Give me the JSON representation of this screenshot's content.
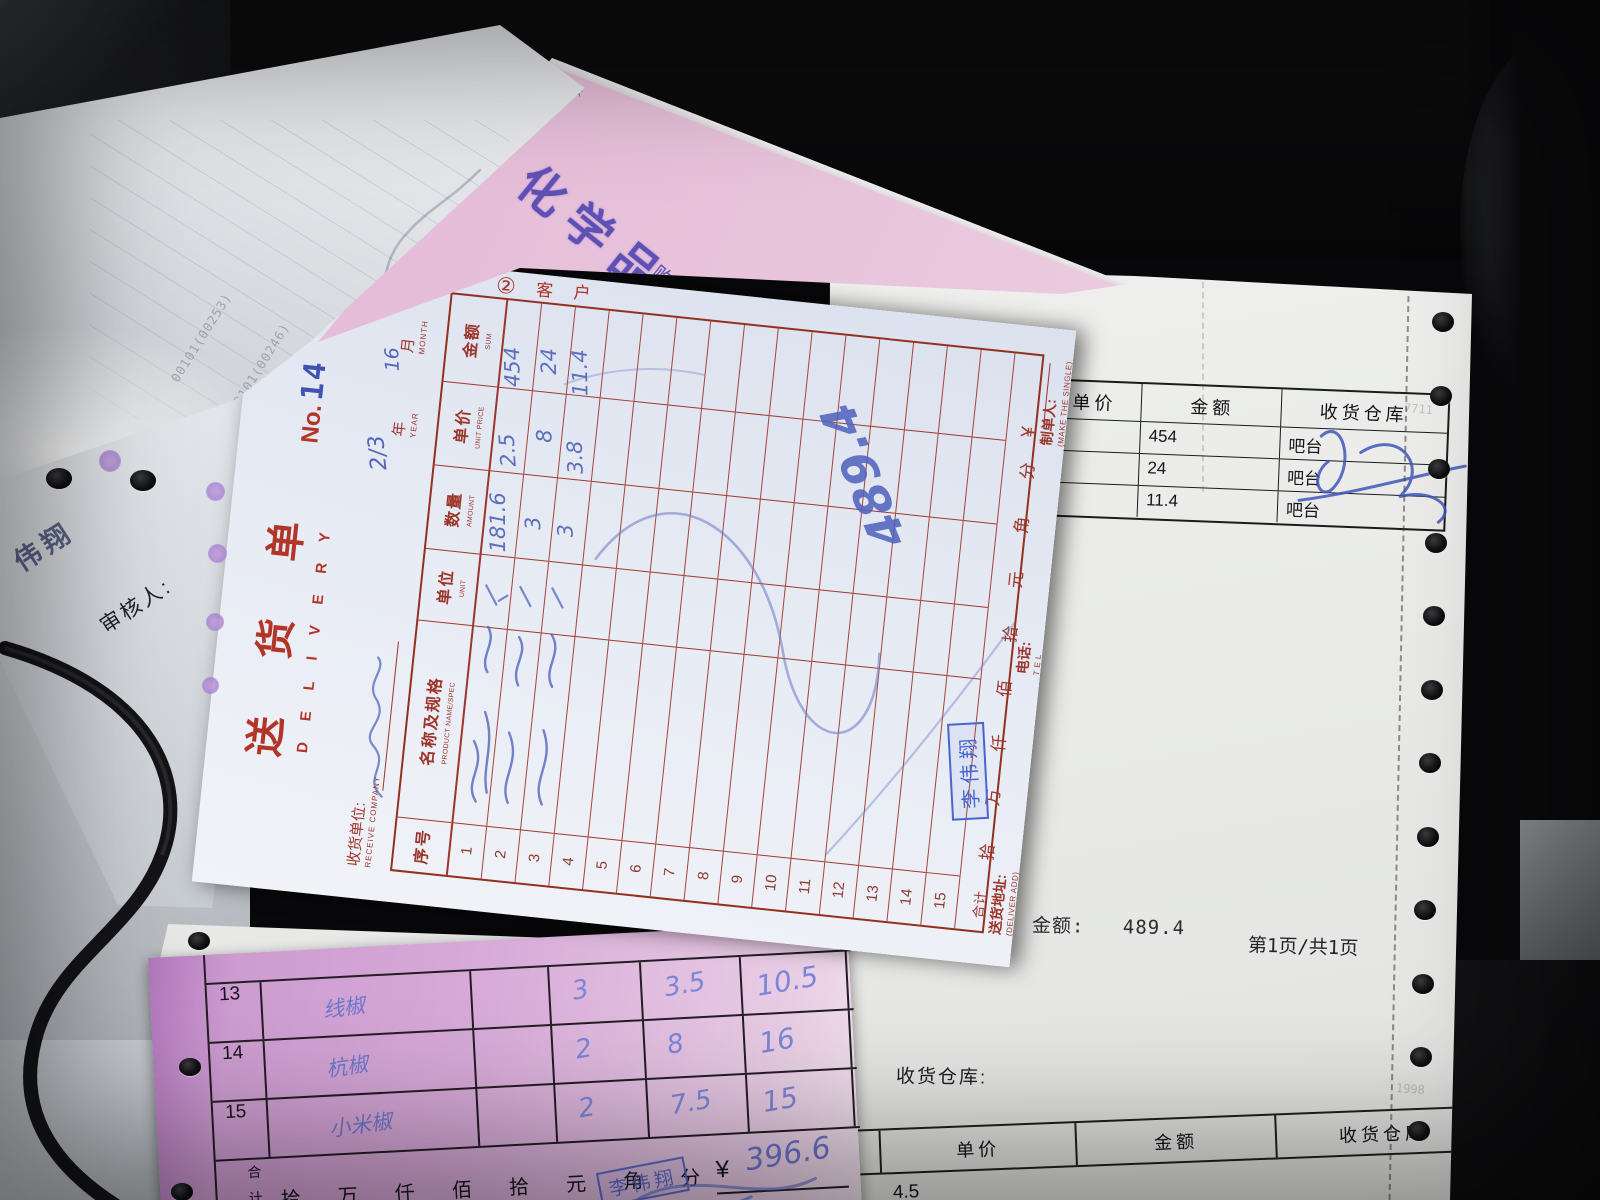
{
  "main_note": {
    "copy_mark": "②",
    "copy_label_1": "客",
    "copy_label_2": "户",
    "title_cn": "送货单",
    "title_en": "DELIVERY",
    "no_label": "No.",
    "no_value": "14",
    "receive_company_label": "收货单位:",
    "receive_company_en": "RECEIVE COMPANY",
    "year_label": "年",
    "year_en": "YEAR",
    "month_label": "月",
    "month_en": "MONTH",
    "date_handwritten": "2/3",
    "date_handwritten2": "16",
    "columns": [
      {
        "cn": "序号",
        "en": ""
      },
      {
        "cn": "名称及规格",
        "en": "PRODUCT NAME/SPEC"
      },
      {
        "cn": "单位",
        "en": "UNIT"
      },
      {
        "cn": "数量",
        "en": "AMOUNT"
      },
      {
        "cn": "单价",
        "en": "UNIT PRICE"
      },
      {
        "cn": "金额",
        "en": "SUM"
      }
    ],
    "row_numbers": [
      "1",
      "2",
      "3",
      "4",
      "5",
      "6",
      "7",
      "8",
      "9",
      "10",
      "11",
      "12",
      "13",
      "14",
      "15"
    ],
    "total_label_1": "合",
    "total_label_2": "计",
    "amount_words": [
      "拾",
      "万",
      "仟",
      "佰",
      "拾",
      "元",
      "角",
      "分"
    ],
    "currency_symbol": "¥",
    "entries": [
      {
        "amount": "181.6",
        "unit_price": "2.5",
        "sum": "454"
      },
      {
        "amount": "3",
        "unit_price": "8",
        "sum": "24"
      },
      {
        "amount": "3",
        "unit_price": "3.8",
        "sum": "11.4"
      }
    ],
    "grand_total_handwritten": "489.4",
    "stamp_name": "李伟翔",
    "deliver_add_label": "送货地址:",
    "deliver_add_en": "(DELIVER ADD)",
    "tel_label": "电话:",
    "tel_en": "T E L",
    "maker_label": "制单人:",
    "maker_en": "(MAKE THE SINGLE)"
  },
  "under_sheet": {
    "table_top": {
      "headers": [
        "单价",
        "金额",
        "收货仓库"
      ],
      "rows": [
        {
          "price": "",
          "amount": "454",
          "warehouse": "吧台"
        },
        {
          "price": "",
          "amount": "24",
          "warehouse": "吧台"
        },
        {
          "price": "",
          "amount": "11.4",
          "warehouse": "吧台"
        }
      ]
    },
    "total_label": "金额:",
    "total_value": "489.4",
    "page_info": "第1页/共1页",
    "warehouse_label": "收货仓库:",
    "table_bottom": {
      "headers": [
        "量",
        "单价",
        "金额",
        "收货仓库"
      ],
      "first_value": "4.5"
    },
    "faint_marks": [
      "7711",
      "1998"
    ]
  },
  "pink_top": {
    "company_text": "化学品有限公司（",
    "buyer_label": "购买单位:",
    "qty_label": "数量",
    "edge_text": "化学品有限公"
  },
  "folded": {
    "codes": [
      "00101(00253)",
      "00101(00246)",
      "00110(01131)"
    ]
  },
  "left_sheet": {
    "auditor_label": "审核人:",
    "name_text": "伟翔"
  },
  "pink_bottom": {
    "rows": [
      {
        "no": "13",
        "name": "线椒",
        "qty": "3",
        "price": "3.5",
        "sum": "10.5"
      },
      {
        "no": "14",
        "name": "杭椒",
        "qty": "2",
        "price": "8",
        "sum": "16"
      },
      {
        "no": "15",
        "name": "小米椒",
        "qty": "2",
        "price": "7.5",
        "sum": "15"
      }
    ],
    "total_label": "合计",
    "amount_words": [
      "拾",
      "万",
      "仟",
      "佰",
      "拾",
      "元",
      "角",
      "分"
    ],
    "currency_symbol": "¥",
    "total_handwritten": "396.6",
    "stamp_name": "李伟翔",
    "deliver_add_label": "送货地址:",
    "deliver_add_en": "(DELIVER ADD)",
    "tel_label": "电话:",
    "maker_label": "制单人:"
  }
}
